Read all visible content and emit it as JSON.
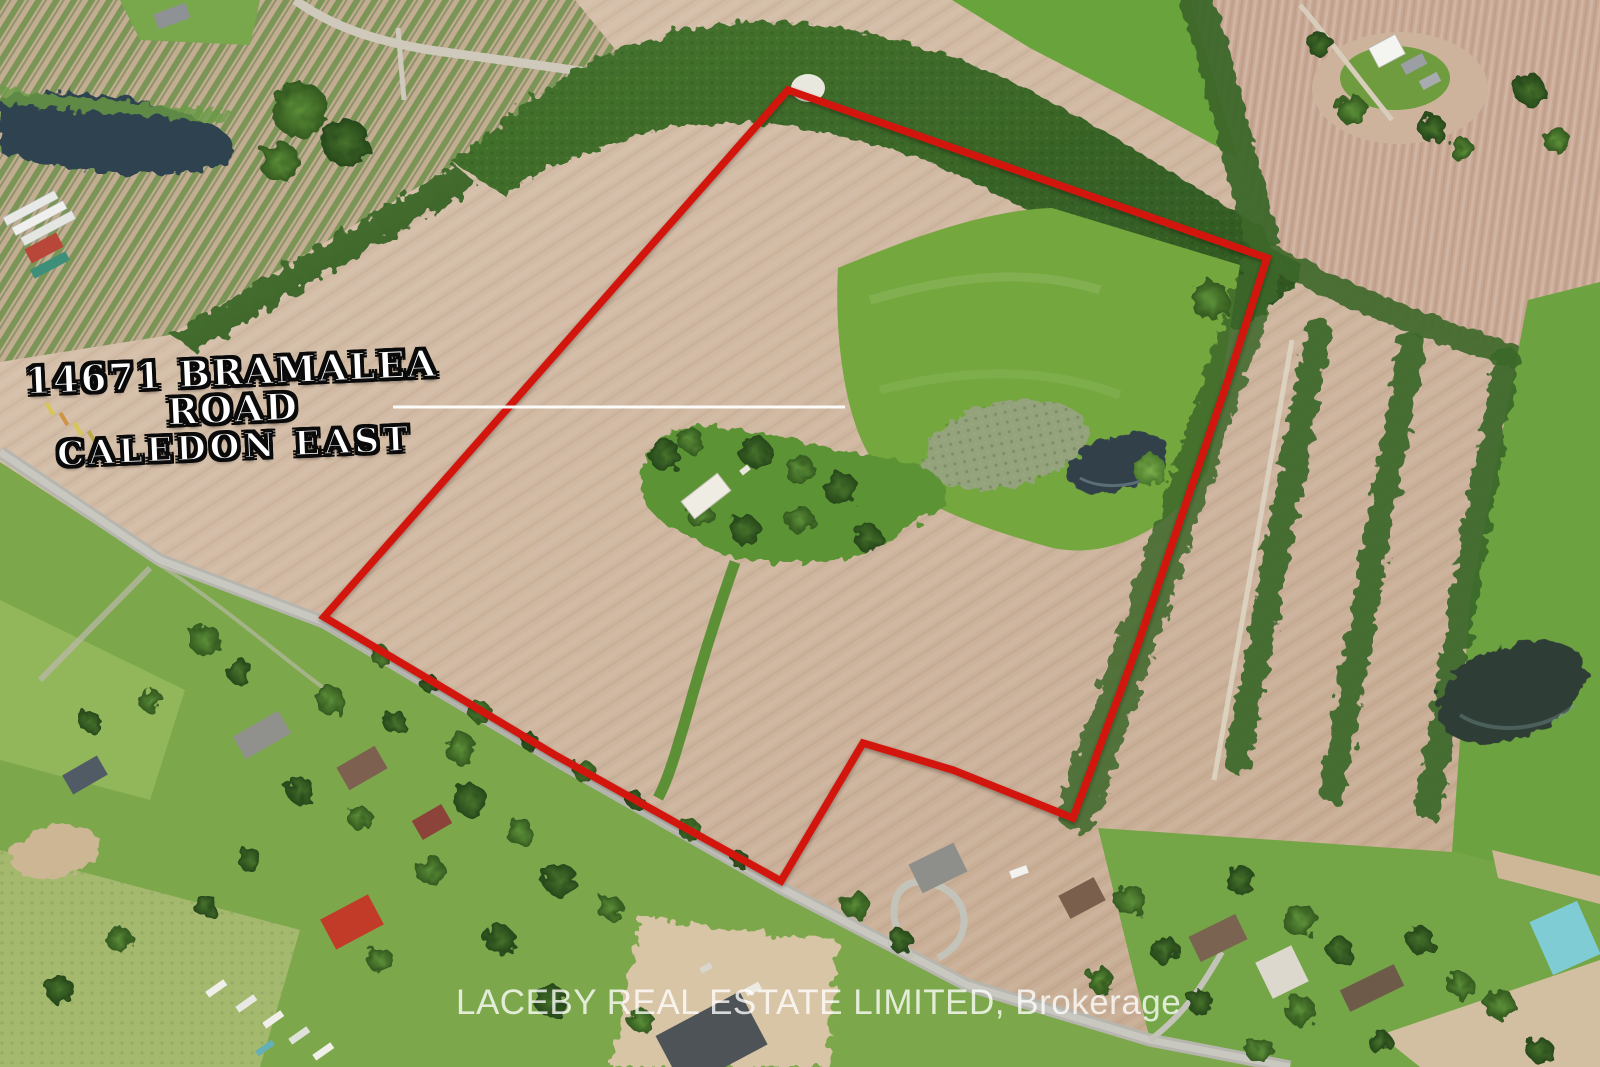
{
  "annotation": {
    "address_line1": "14671 BRAMALEA ROAD",
    "address_line2": "CALEDON EAST",
    "text_color": "#ffffff",
    "outline_color": "#0a0a0a"
  },
  "watermark": {
    "text": "LACEBY REAL ESTATE LIMITED, Brokerage",
    "color": "rgba(255,255,255,0.78)"
  },
  "boundary": {
    "color": "#d3190b",
    "stroke_width": 7.5,
    "points": [
      [
        788,
        90
      ],
      [
        1267,
        258
      ],
      [
        1228,
        380
      ],
      [
        1136,
        650
      ],
      [
        1073,
        818
      ],
      [
        953,
        770
      ],
      [
        863,
        743
      ],
      [
        781,
        881
      ],
      [
        680,
        825
      ],
      [
        555,
        755
      ],
      [
        430,
        680
      ],
      [
        324,
        617
      ]
    ]
  },
  "pointer_line": {
    "x1": 393,
    "y1": 407,
    "x2": 845,
    "y2": 407,
    "color": "#ffffff",
    "width": 3
  },
  "scene": {
    "palette": {
      "field_tan": "#cdb49d",
      "field_pink": "#c8a793",
      "pasture_green": "#74a73d",
      "forest_green": "#3b672b",
      "lawn_green": "#7ca74b",
      "pond_dark": "#30414a",
      "road_grey": "#b7b6ae",
      "boundary_red": "#d3190b"
    }
  }
}
